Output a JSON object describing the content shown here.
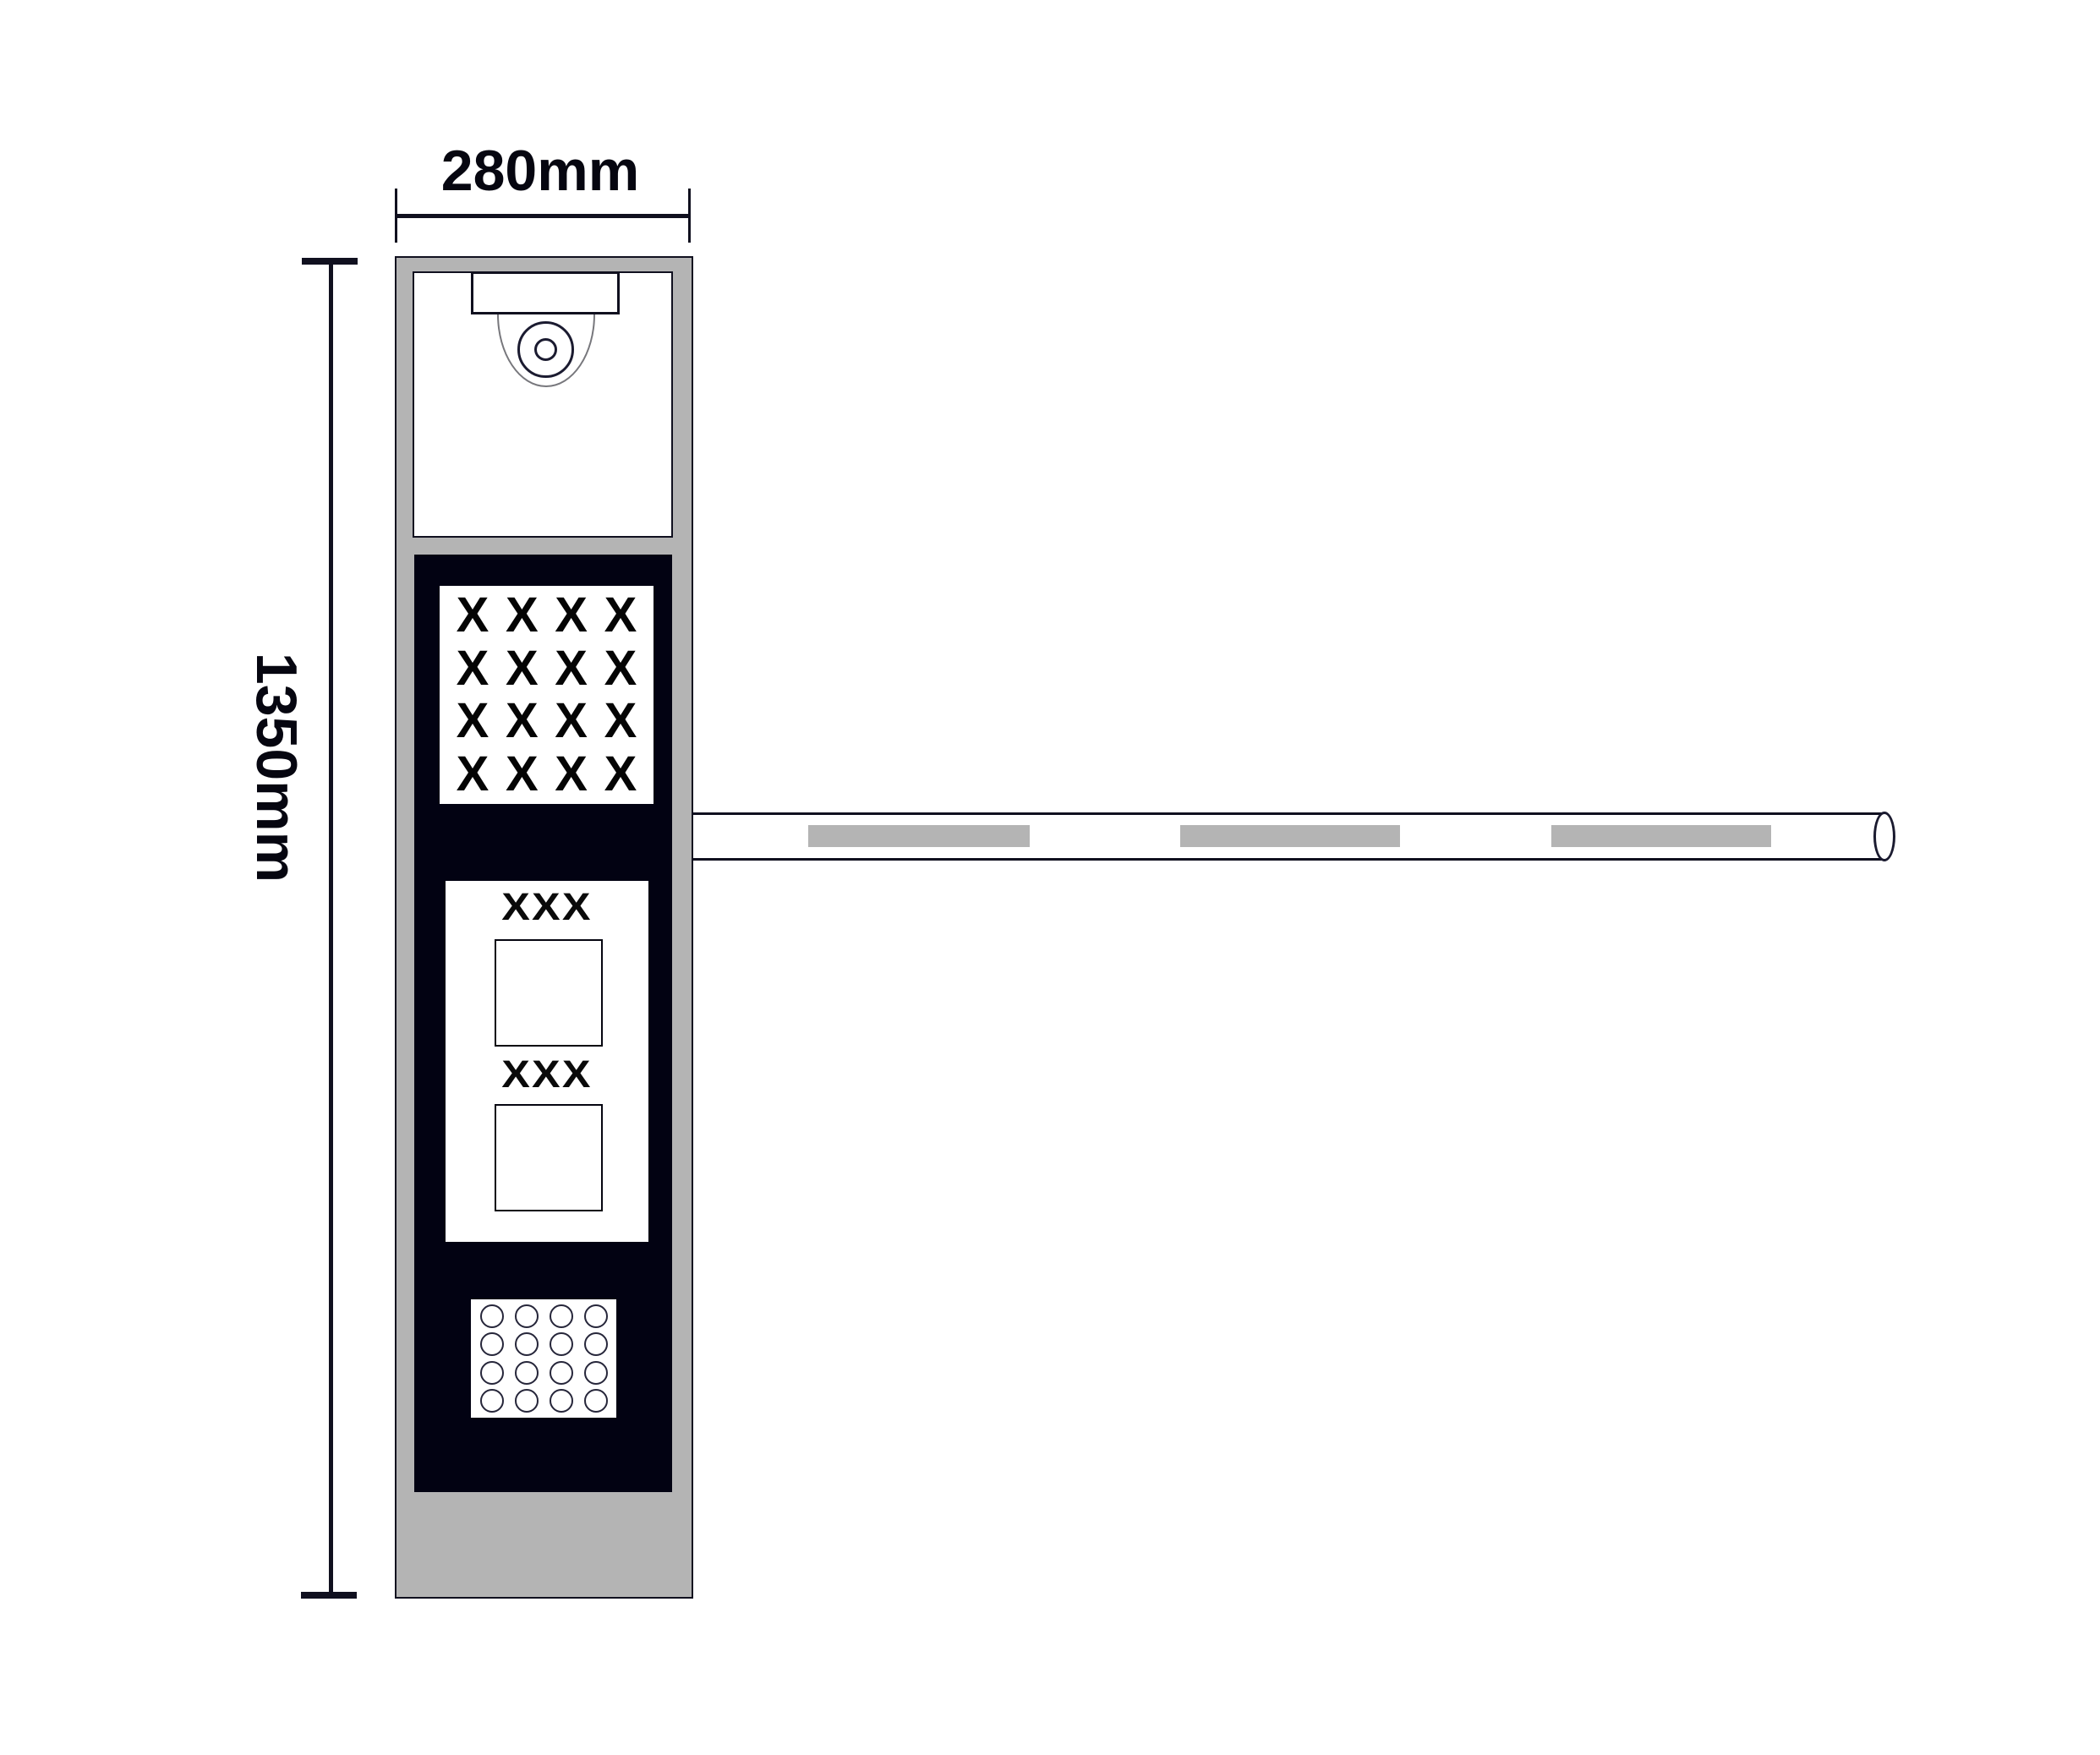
{
  "dimensions": {
    "width": {
      "label": "280mm"
    },
    "height": {
      "label": "1350mm"
    }
  },
  "pillar": {
    "sign_grid": {
      "rows": 4,
      "cols": 4,
      "char": "X"
    },
    "displays": [
      {
        "label": "XXX"
      },
      {
        "label": "XXX"
      }
    ],
    "keypad": {
      "rows": 4,
      "cols": 4
    }
  },
  "arm": {
    "stripe_count": 3
  },
  "colors": {
    "pillar_gray": "#b4b4b4",
    "panel_black": "#020212",
    "line_ink": "#10101f"
  }
}
